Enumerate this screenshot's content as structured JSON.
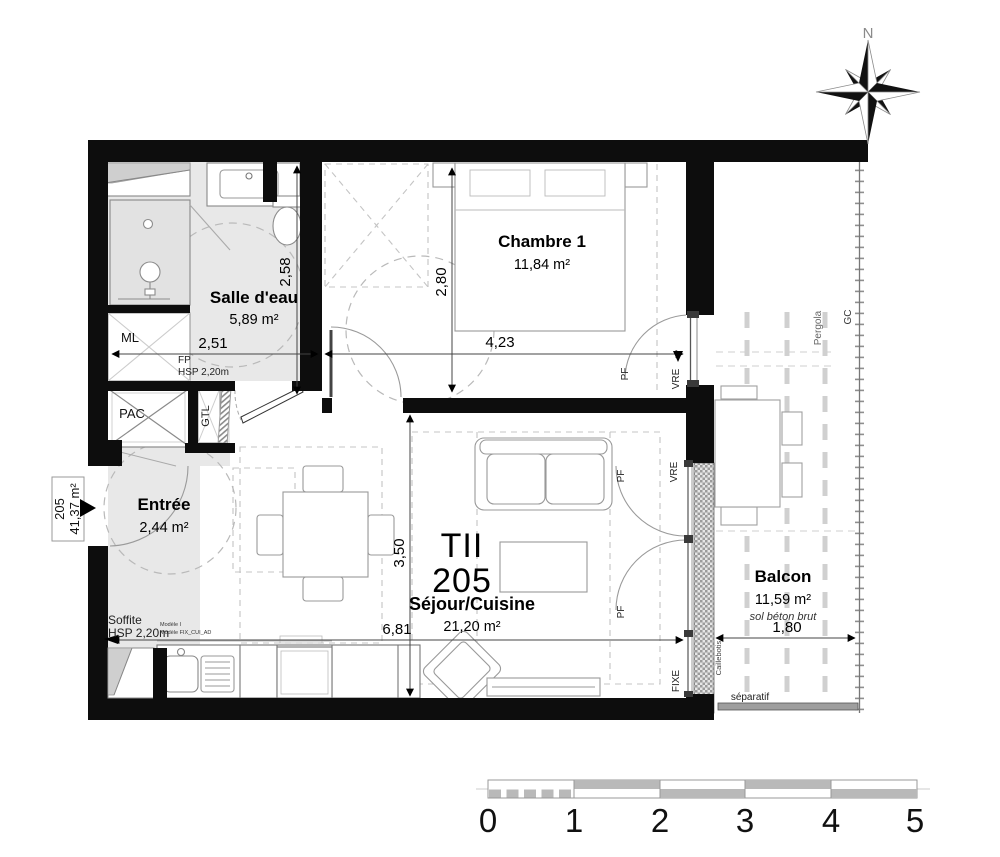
{
  "apartment": {
    "type_label": "TII",
    "number": "205",
    "side_number": "205",
    "side_area": "41,37 m²"
  },
  "rooms": {
    "bathroom": {
      "name": "Salle d'eau",
      "area": "5,89 m²"
    },
    "bedroom": {
      "name": "Chambre 1",
      "area": "11,84 m²"
    },
    "entry": {
      "name": "Entrée",
      "area": "2,44 m²"
    },
    "living": {
      "name": "Séjour/Cuisine",
      "area": "21,20 m²"
    },
    "balcony": {
      "name": "Balcon",
      "area": "11,59 m²",
      "floor_note": "sol béton brut"
    }
  },
  "dims": {
    "bathroom_w": "2,51",
    "bathroom_h": "2,58",
    "bedroom_h": "2,80",
    "bedroom_w": "4,23",
    "living_h": "3,50",
    "living_w": "6,81",
    "balcony_w": "1,80"
  },
  "tech": {
    "ml": "ML",
    "pac": "PAC",
    "gtl": "GTL",
    "fp": "FP",
    "fp_hsp": "HSP 2,20m",
    "soffite": "Soffite",
    "soffite_hsp": "HSP 2,20m",
    "module_line1": "Modèle I",
    "module_line2": "Modèle FIX_CUI_AD",
    "pf": "PF",
    "vre": "VRE",
    "fixe": "FIXE",
    "caillebotis": "Caillebotis",
    "separatif": "séparatif",
    "pergola": "Pergola",
    "gc": "GC"
  },
  "compass": {
    "north": "N"
  },
  "scale_bar": {
    "labels": [
      "0",
      "1",
      "2",
      "3",
      "4",
      "5"
    ]
  },
  "colors": {
    "wall": "#0d0d0d",
    "floor_gray": "#e8e8e8",
    "furniture_stroke": "#999999",
    "hatch_gray": "#9b9b9b",
    "scale_gray": "#b9b9b9"
  }
}
